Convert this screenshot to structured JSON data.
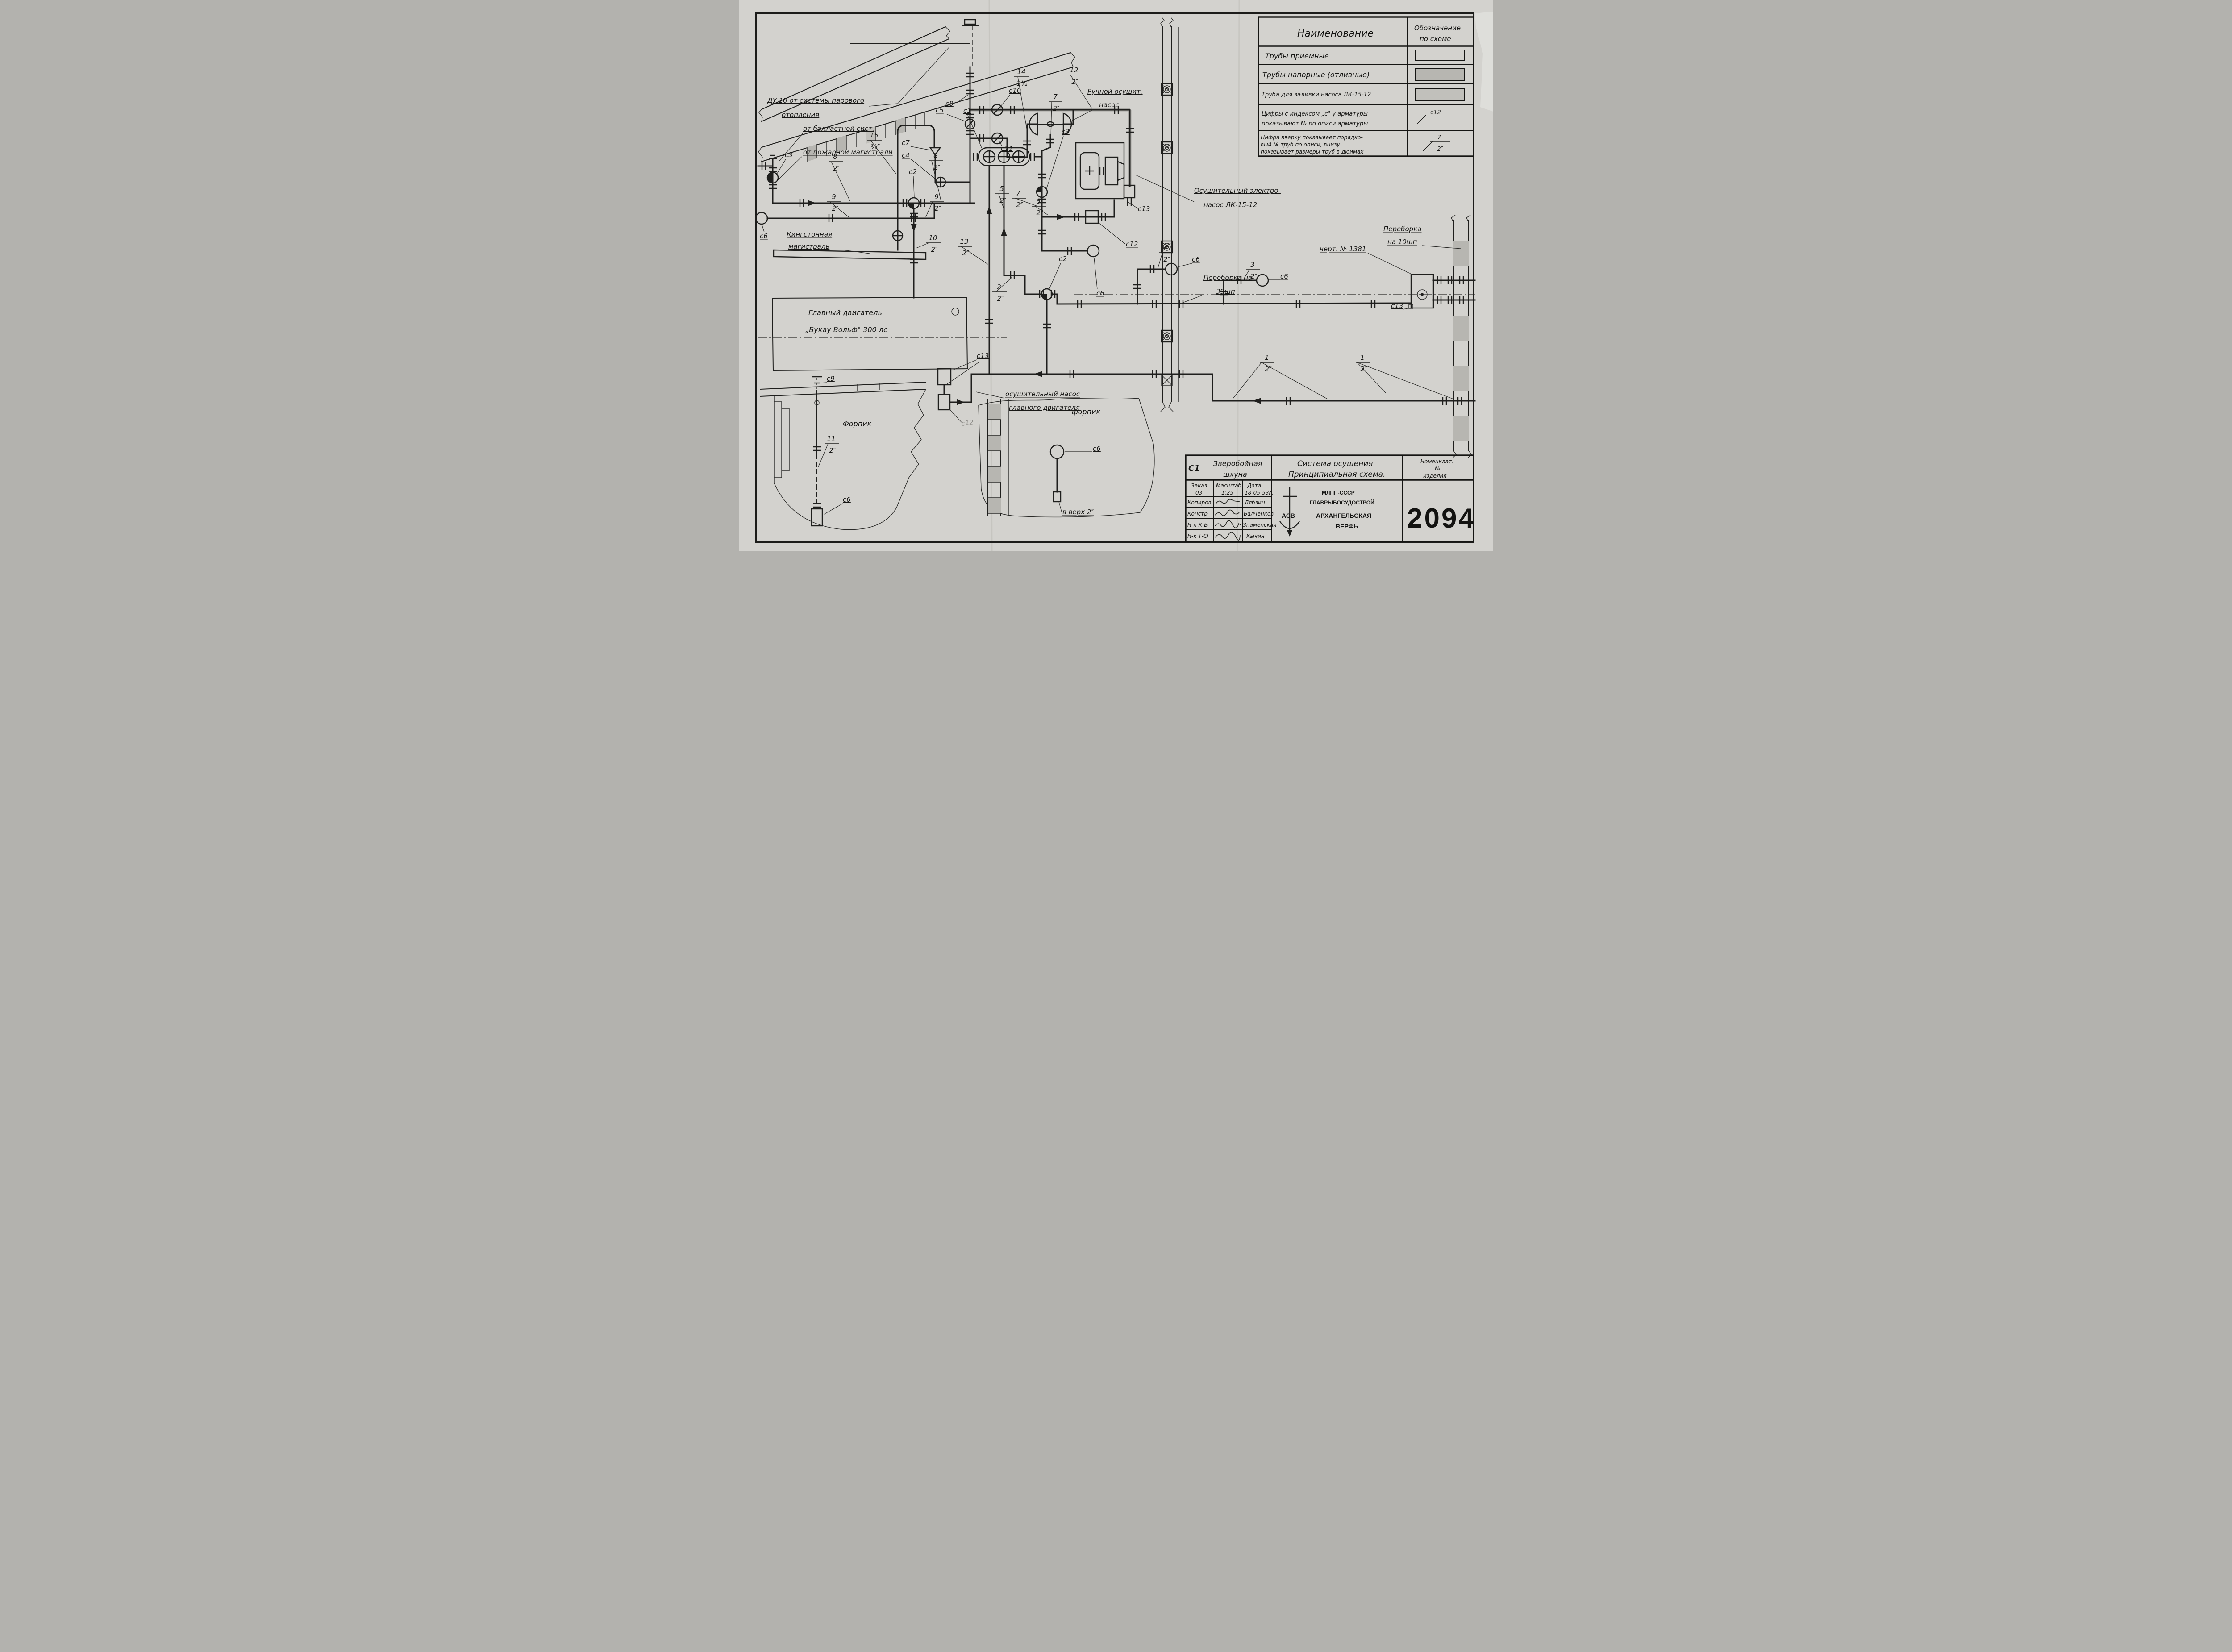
{
  "sheet": {
    "number": "2094",
    "code": "С1"
  },
  "legend": {
    "header_name": "Наименование",
    "header_sym1": "Обозначение",
    "header_sym2": "по схеме",
    "row1": "Трубы  приемные",
    "row2": "Трубы  напорные (отливные)",
    "row3": "Труба для заливки насоса ЛК-15-12",
    "row4a": "Цифры с индексом „с\" у арматуры",
    "row4b": "показывают  №  по  описи арматуры",
    "row5a": "Цифра вверху показывает порядко-",
    "row5b": "вый  №  труб  по  описи,  внизу",
    "row5c": "показывает размеры труб в дюймах"
  },
  "title_block": {
    "ship1": "Зверобойная",
    "ship2": "шхуна",
    "title1": "Система осушения",
    "title2": "Принципиальная схема.",
    "nomen1": "Номенклат.",
    "nomen2": "№",
    "nomen3": "изделия",
    "order_label": "Заказ",
    "order_value": "03",
    "scale_label": "Масштаб",
    "scale_value": "1:25",
    "date_label": "Дата",
    "date_value": "18-05-53г.",
    "rows": [
      {
        "role": "Копиров.",
        "name": "Лябзин"
      },
      {
        "role": "Констр.",
        "name": "Балченков"
      },
      {
        "role": "Н-к К-Б",
        "name": "Знаменская"
      },
      {
        "role": "Н-к Т-О",
        "name": "Кычин"
      }
    ],
    "org1": "МЛПП-СССР",
    "org2": "ГЛАВРЫБОСУДОСТРОЙ",
    "org3": "АРХАНГЕЛЬСКАЯ",
    "org4": "ВЕРФЬ",
    "logo": "АСВ"
  },
  "labels": {
    "du10a": "ДУ 10 от системы парового",
    "du10b": "отопления",
    "ballast": "от балластной сист.",
    "fire": "от пожарной магистрали",
    "hand1": "Ручной осушит.",
    "hand2": "насос",
    "elpump1": "Осушительный электро-",
    "elpump2": "насос ЛК-15-12",
    "bh39a": "Переборка на",
    "bh39b": "39шп",
    "bh10a": "Переборка",
    "bh10b": "на 10шп",
    "chert": "черт. № 1381",
    "king1": "Кингстонная",
    "king2": "магистраль",
    "eng1": "Главный двигатель",
    "eng2": "„Букау Вольф\"  300 лс",
    "engpump1": "осушительный насос",
    "engpump2": "главного двигателя",
    "forpik1": "Форпик",
    "forpik2": "форпик",
    "vverh": "в верх 2″"
  },
  "valves": {
    "c1": "с1",
    "c2": "с2",
    "c3": "с3",
    "c4": "с4",
    "c5": "с5",
    "c6": "с6",
    "c7": "с7",
    "c8": "с8",
    "c9": "с9",
    "c10": "с10",
    "c11": "с11",
    "c12": "с12",
    "c13": "с13"
  },
  "fractions": {
    "f12_2": {
      "n": "12",
      "d": "2″"
    },
    "f14_15": {
      "n": "14",
      "d": "1½″"
    },
    "f7_2": {
      "n": "7",
      "d": "2″"
    },
    "f8_2": {
      "n": "8",
      "d": "2″"
    },
    "f15_34": {
      "n": "15",
      "d": "¾″"
    },
    "f9_2": {
      "n": "9",
      "d": "2″"
    },
    "f10_2": {
      "n": "10",
      "d": "2″"
    },
    "f13_2": {
      "n": "13",
      "d": "2″"
    },
    "f5_2": {
      "n": "5",
      "d": "2″"
    },
    "f6_2": {
      "n": "6",
      "d": "2″"
    },
    "f2_2": {
      "n": "2",
      "d": "2″"
    },
    "f4_2": {
      "n": "4",
      "d": "2″"
    },
    "f3_2": {
      "n": "3",
      "d": "2″"
    },
    "f1_2": {
      "n": "1",
      "d": "2″"
    },
    "f11_2": {
      "n": "11",
      "d": "2″"
    }
  }
}
